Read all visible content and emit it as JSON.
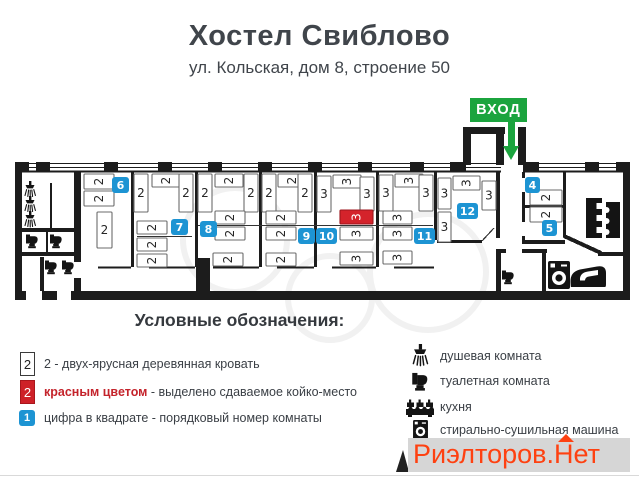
{
  "header": {
    "title": "Хостел Свиблово",
    "subtitle": "ул. Кольская, дом 8, строение 50"
  },
  "entrance": {
    "label": "ВХОД",
    "color": "#1ba43e"
  },
  "colors": {
    "badge_blue": "#1d94d3",
    "bed_red": "#d4232b",
    "wall": "#1c1c1c",
    "watermark_red": "#fe4111",
    "watermark_bg": "#d6d6d6"
  },
  "floorplan": {
    "rooms": [
      {
        "number": "4",
        "x": 525,
        "y": 177,
        "w": 15
      },
      {
        "number": "5",
        "x": 542,
        "y": 220,
        "w": 15
      },
      {
        "number": "6",
        "x": 112,
        "y": 177,
        "w": 17
      },
      {
        "number": "7",
        "x": 171,
        "y": 219,
        "w": 17
      },
      {
        "number": "8",
        "x": 200,
        "y": 221,
        "w": 17
      },
      {
        "number": "9",
        "x": 298,
        "y": 228,
        "w": 17
      },
      {
        "number": "10",
        "x": 316,
        "y": 228,
        "w": 21
      },
      {
        "number": "11",
        "x": 414,
        "y": 228,
        "w": 21
      },
      {
        "number": "12",
        "x": 457,
        "y": 203,
        "w": 21
      }
    ],
    "beds": [
      {
        "x": 84,
        "y": 174,
        "w": 30,
        "h": 15,
        "label": "2",
        "o": "h"
      },
      {
        "x": 84,
        "y": 191,
        "w": 30,
        "h": 15,
        "label": "2",
        "o": "h"
      },
      {
        "x": 97,
        "y": 212,
        "w": 15,
        "h": 36,
        "label": "2",
        "o": "v"
      },
      {
        "x": 134,
        "y": 174,
        "w": 14,
        "h": 38,
        "label": "2",
        "o": "v"
      },
      {
        "x": 152,
        "y": 174,
        "w": 28,
        "h": 13,
        "label": "2",
        "o": "h"
      },
      {
        "x": 179,
        "y": 174,
        "w": 14,
        "h": 38,
        "label": "2",
        "o": "v"
      },
      {
        "x": 137,
        "y": 221,
        "w": 30,
        "h": 13,
        "label": "2",
        "o": "h"
      },
      {
        "x": 137,
        "y": 238,
        "w": 30,
        "h": 13,
        "label": "2",
        "o": "h"
      },
      {
        "x": 137,
        "y": 254,
        "w": 30,
        "h": 13,
        "label": "2",
        "o": "h"
      },
      {
        "x": 198,
        "y": 174,
        "w": 14,
        "h": 38,
        "label": "2",
        "o": "v"
      },
      {
        "x": 215,
        "y": 174,
        "w": 28,
        "h": 13,
        "label": "2",
        "o": "h"
      },
      {
        "x": 244,
        "y": 174,
        "w": 14,
        "h": 38,
        "label": "2",
        "o": "v"
      },
      {
        "x": 215,
        "y": 211,
        "w": 30,
        "h": 13,
        "label": "2",
        "o": "h"
      },
      {
        "x": 215,
        "y": 227,
        "w": 30,
        "h": 13,
        "label": "2",
        "o": "h"
      },
      {
        "x": 213,
        "y": 253,
        "w": 30,
        "h": 13,
        "label": "2",
        "o": "h"
      },
      {
        "x": 262,
        "y": 174,
        "w": 14,
        "h": 38,
        "label": "2",
        "o": "v"
      },
      {
        "x": 278,
        "y": 174,
        "w": 28,
        "h": 13,
        "label": "2",
        "o": "h"
      },
      {
        "x": 298,
        "y": 174,
        "w": 14,
        "h": 38,
        "label": "2",
        "o": "v"
      },
      {
        "x": 266,
        "y": 211,
        "w": 30,
        "h": 13,
        "label": "2",
        "o": "h"
      },
      {
        "x": 266,
        "y": 227,
        "w": 30,
        "h": 13,
        "label": "2",
        "o": "h"
      },
      {
        "x": 266,
        "y": 253,
        "w": 30,
        "h": 13,
        "label": "2",
        "o": "h"
      },
      {
        "x": 317,
        "y": 176,
        "w": 14,
        "h": 36,
        "label": "3",
        "o": "v"
      },
      {
        "x": 333,
        "y": 175,
        "w": 28,
        "h": 13,
        "label": "3",
        "o": "h"
      },
      {
        "x": 360,
        "y": 177,
        "w": 14,
        "h": 34,
        "label": "3",
        "o": "v"
      },
      {
        "x": 340,
        "y": 210,
        "w": 33,
        "h": 14,
        "label": "3",
        "o": "h",
        "red": true
      },
      {
        "x": 340,
        "y": 227,
        "w": 33,
        "h": 13,
        "label": "3",
        "o": "h"
      },
      {
        "x": 340,
        "y": 252,
        "w": 33,
        "h": 13,
        "label": "3",
        "o": "h"
      },
      {
        "x": 379,
        "y": 175,
        "w": 14,
        "h": 36,
        "label": "3",
        "o": "v"
      },
      {
        "x": 395,
        "y": 174,
        "w": 28,
        "h": 13,
        "label": "3",
        "o": "h"
      },
      {
        "x": 419,
        "y": 175,
        "w": 14,
        "h": 36,
        "label": "3",
        "o": "v"
      },
      {
        "x": 383,
        "y": 211,
        "w": 29,
        "h": 13,
        "label": "3",
        "o": "h"
      },
      {
        "x": 383,
        "y": 227,
        "w": 29,
        "h": 13,
        "label": "3",
        "o": "h"
      },
      {
        "x": 383,
        "y": 251,
        "w": 29,
        "h": 13,
        "label": "3",
        "o": "h"
      },
      {
        "x": 438,
        "y": 178,
        "w": 13,
        "h": 31,
        "label": "3",
        "o": "v"
      },
      {
        "x": 438,
        "y": 212,
        "w": 13,
        "h": 30,
        "label": "3",
        "o": "v"
      },
      {
        "x": 453,
        "y": 176,
        "w": 27,
        "h": 14,
        "label": "3",
        "o": "h"
      },
      {
        "x": 482,
        "y": 181,
        "w": 14,
        "h": 29,
        "label": "3",
        "o": "v"
      },
      {
        "x": 530,
        "y": 190,
        "w": 32,
        "h": 15,
        "label": "2",
        "o": "h"
      },
      {
        "x": 530,
        "y": 207,
        "w": 32,
        "h": 15,
        "label": "2",
        "o": "h"
      }
    ],
    "fixtures": [
      {
        "type": "shower",
        "x": 24,
        "y": 181
      },
      {
        "type": "shower",
        "x": 24,
        "y": 196
      },
      {
        "type": "shower",
        "x": 24,
        "y": 211
      },
      {
        "type": "toilet",
        "x": 26,
        "y": 233
      },
      {
        "type": "toilet",
        "x": 50,
        "y": 233
      },
      {
        "type": "toilet",
        "x": 45,
        "y": 259
      },
      {
        "type": "toilet",
        "x": 62,
        "y": 259
      },
      {
        "type": "toilet",
        "x": 502,
        "y": 269
      },
      {
        "type": "counter",
        "x": 586,
        "y": 198
      },
      {
        "type": "stove",
        "x": 606,
        "y": 202
      },
      {
        "type": "washer",
        "x": 548,
        "y": 261
      },
      {
        "type": "iron",
        "x": 570,
        "y": 262
      }
    ]
  },
  "legend": {
    "heading": "Условные обозначения:",
    "items": [
      {
        "box_label": "2",
        "text": "2 - двух-ярусная деревянная кровать"
      },
      {
        "box_label": "2",
        "text_highlight": "красным цветом",
        "text": " - выделено сдаваемое койко-место"
      },
      {
        "box_label": "1",
        "text": "цифра в квадрате - порядковый номер комнаты"
      }
    ],
    "facilities": [
      {
        "icon": "shower-icon",
        "text": "душевая комната"
      },
      {
        "icon": "toilet-icon",
        "text": "туалетная комната"
      },
      {
        "icon": "kitchen-icon",
        "text": "кухня"
      },
      {
        "icon": "washer-icon",
        "text": "стирально-сушильная машина"
      }
    ]
  },
  "watermark": {
    "text": "Риэлторов.Нет"
  }
}
